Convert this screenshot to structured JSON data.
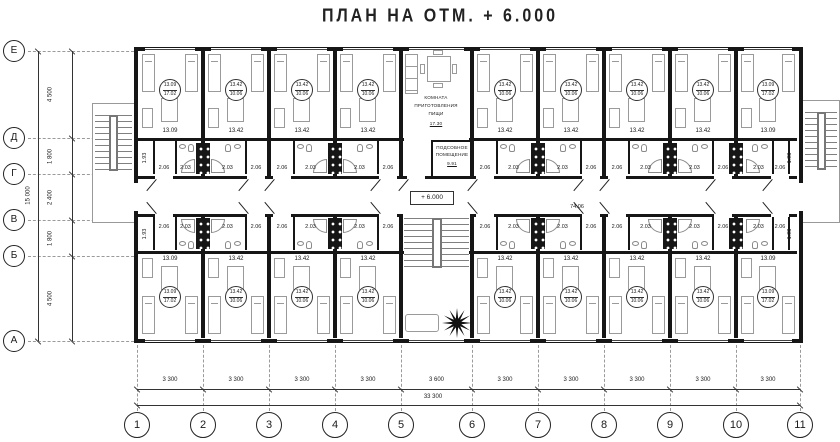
{
  "title": "ПЛАН НА ОТМ. + 6.000",
  "axes": {
    "row_letters": [
      "Е",
      "Д",
      "Г",
      "В",
      "Б",
      "А"
    ],
    "row_dims": [
      "4 500",
      "1 800",
      "2 400",
      "1 800",
      "4 500"
    ],
    "row_total": "15 000",
    "col_numbers": [
      "1",
      "2",
      "3",
      "4",
      "5",
      "6",
      "7",
      "8",
      "9",
      "10",
      "11"
    ],
    "col_dims": [
      "3 300",
      "3 300",
      "3 300",
      "3 300",
      "3 600",
      "3 300",
      "3 300",
      "3 300",
      "3 300",
      "3 300"
    ],
    "col_total": "33 300"
  },
  "rooms": {
    "standard": {
      "label_top": "13.42",
      "label_bottom": "10.06",
      "dim": "13.42"
    },
    "corner": {
      "label_top": "13.09",
      "label_bottom": "17.02",
      "dim": "13.09"
    },
    "bath_area": "2.03",
    "entry_area": "2.06",
    "edge_area": "1.93"
  },
  "kitchen": {
    "name": [
      "КОМНАТА",
      "ПРИГОТОВЛЕНИЯ",
      "ПИЩИ"
    ],
    "area": "17.30"
  },
  "utility": {
    "name": [
      "ПОДСОБНОЕ",
      "ПОМЕЩЕНИЕ"
    ],
    "area": "9.91"
  },
  "corridor": {
    "elevation": "+ 6.000",
    "area": "74.06"
  },
  "layout_modules": {
    "top": [
      "corner",
      "standard",
      "standard",
      "standard",
      "kitchen",
      "standard",
      "standard",
      "standard",
      "standard",
      "corner"
    ],
    "bottom": [
      "corner",
      "standard",
      "standard",
      "standard",
      "stair",
      "standard",
      "standard",
      "standard",
      "standard",
      "corner"
    ]
  }
}
